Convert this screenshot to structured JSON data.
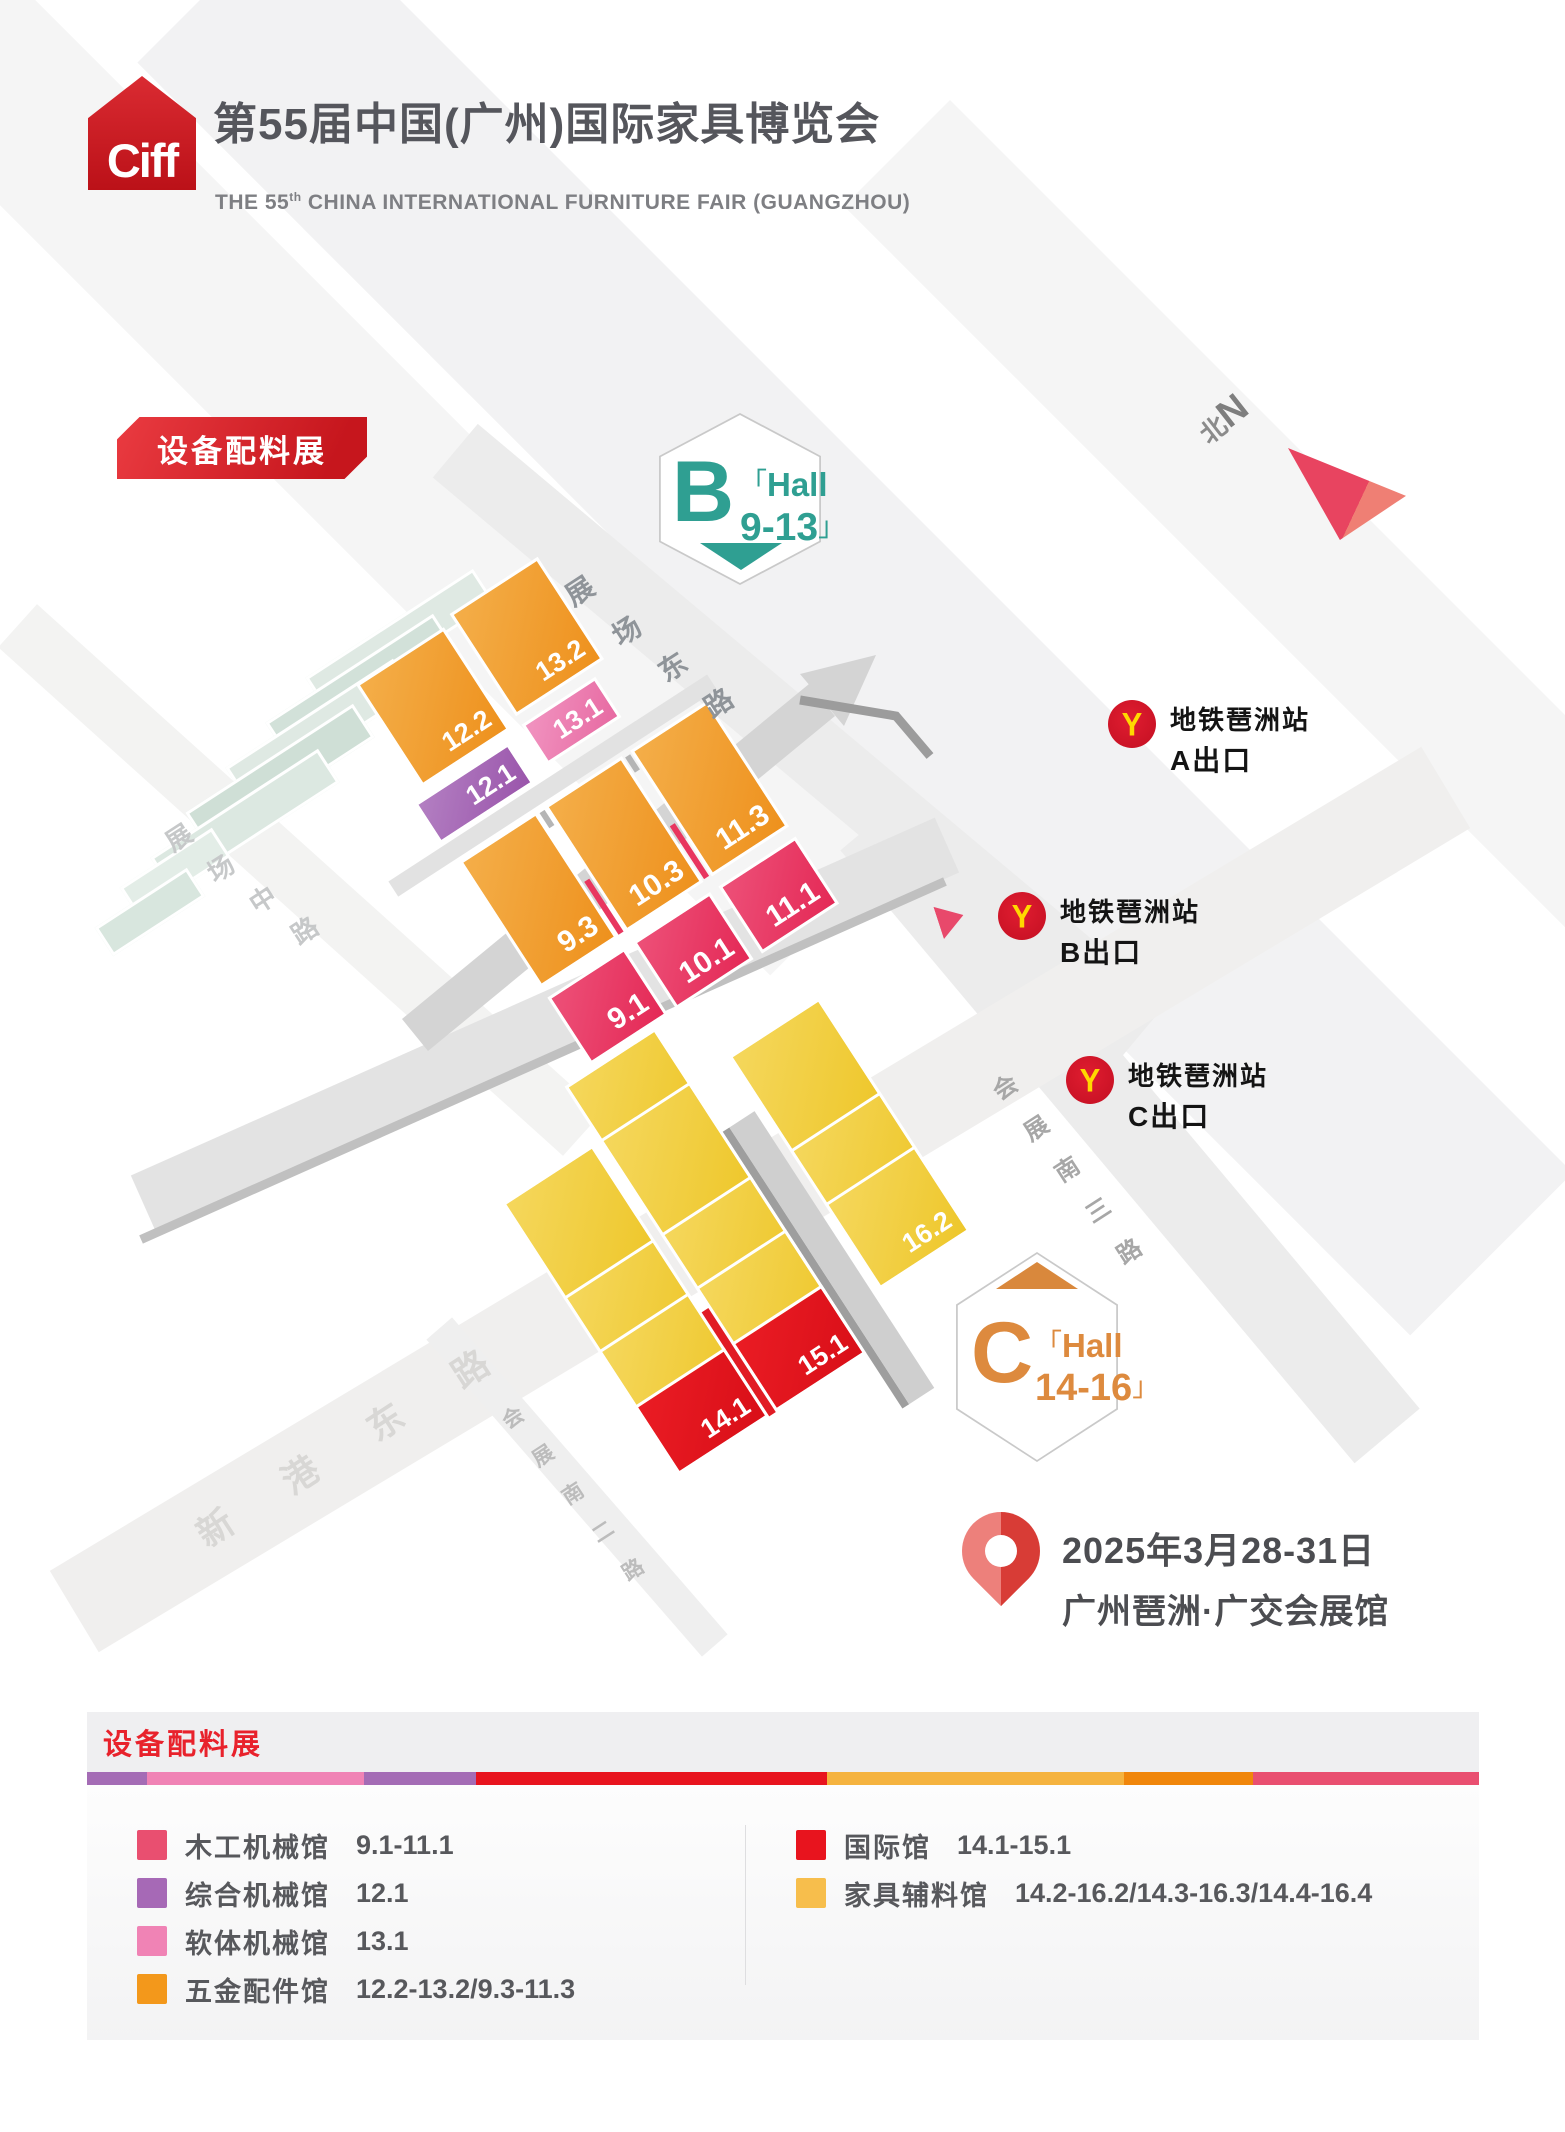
{
  "header": {
    "logo_text": "Ciff",
    "title": "第55届中国(广州)国际家具博览会",
    "subtitle_pre": "THE 55",
    "subtitle_sup": "th",
    "subtitle_post": " CHINA INTERNATIONAL FURNITURE FAIR (GUANGZHOU)"
  },
  "map": {
    "expo_badge": "设备配料展",
    "north": {
      "zh": "北",
      "en": "N"
    },
    "hex_b": {
      "letter": "B",
      "open": "「",
      "word": "Hall",
      "range": "9-13",
      "close": "」"
    },
    "hex_c": {
      "letter": "C",
      "open": "「",
      "word": "Hall",
      "range": "14-16",
      "close": "」"
    },
    "metro": [
      {
        "station": "地铁琶洲站",
        "exit": "A出口",
        "logo": "Y"
      },
      {
        "station": "地铁琶洲站",
        "exit": "B出口",
        "logo": "Y"
      },
      {
        "station": "地铁琶洲站",
        "exit": "C出口",
        "logo": "Y"
      }
    ],
    "date_line1": "2025年3月28-31日",
    "date_line2": "广州琶洲·广交会展馆",
    "halls": {
      "h12_2": "12.2",
      "h13_2": "13.2",
      "h12_1": "12.1",
      "h13_1": "13.1",
      "h9_3": "9.3",
      "h10_3": "10.3",
      "h11_3": "11.3",
      "h9_1": "9.1",
      "h10_1": "10.1",
      "h11_1": "11.1",
      "c14_3": "14.3",
      "c15_3": "15.3",
      "c16_3": "16.3",
      "c14_2": "14.2",
      "c15_2": "15.2",
      "c16_2": "16.2",
      "c14_1": "14.1",
      "c15_1": "15.1"
    },
    "roads": {
      "zhanchang_dong": [
        "展",
        "场",
        "东",
        "路"
      ],
      "zhanchang_zhong": [
        "展",
        "场",
        "中",
        "路"
      ],
      "xingang_dong": [
        "新",
        "港",
        "东",
        "路"
      ],
      "huizhan_nan3": [
        "会",
        "展",
        "南",
        "三",
        "路"
      ],
      "huizhan_nan2": [
        "会",
        "展",
        "南",
        "二",
        "路"
      ]
    },
    "colors": {
      "orange_hall": "#ef9722",
      "crimson_hall": "#e8365f",
      "purple_hall": "#a569b5",
      "pink_hall": "#ec7fb1",
      "yellow_hall": "#f2ce3d",
      "red_hall": "#e50f1e",
      "teal_accent": "#2f9f92",
      "hex_c_orange": "#dd8a3e",
      "brand_red": "#d6212b"
    }
  },
  "legend": {
    "title": "设备配料展",
    "stripe": [
      "#a46cb5",
      "#f083b5",
      "#a46cb5",
      "#e8141e",
      "#f5b33f",
      "#f0860b",
      "#e94f70"
    ],
    "left": [
      {
        "color": "#e94f70",
        "label": "木工机械馆",
        "range": "9.1-11.1"
      },
      {
        "color": "#a669b6",
        "label": "综合机械馆",
        "range": "12.1"
      },
      {
        "color": "#f083b5",
        "label": "软体机械馆",
        "range": "13.1"
      },
      {
        "color": "#f3981b",
        "label": "五金配件馆",
        "range": "12.2-13.2/9.3-11.3"
      }
    ],
    "right": [
      {
        "color": "#e8141e",
        "label": "国际馆",
        "range": "14.1-15.1"
      },
      {
        "color": "#f7be4c",
        "label": "家具辅料馆",
        "range": "14.2-16.2/14.3-16.3/14.4-16.4"
      }
    ]
  }
}
